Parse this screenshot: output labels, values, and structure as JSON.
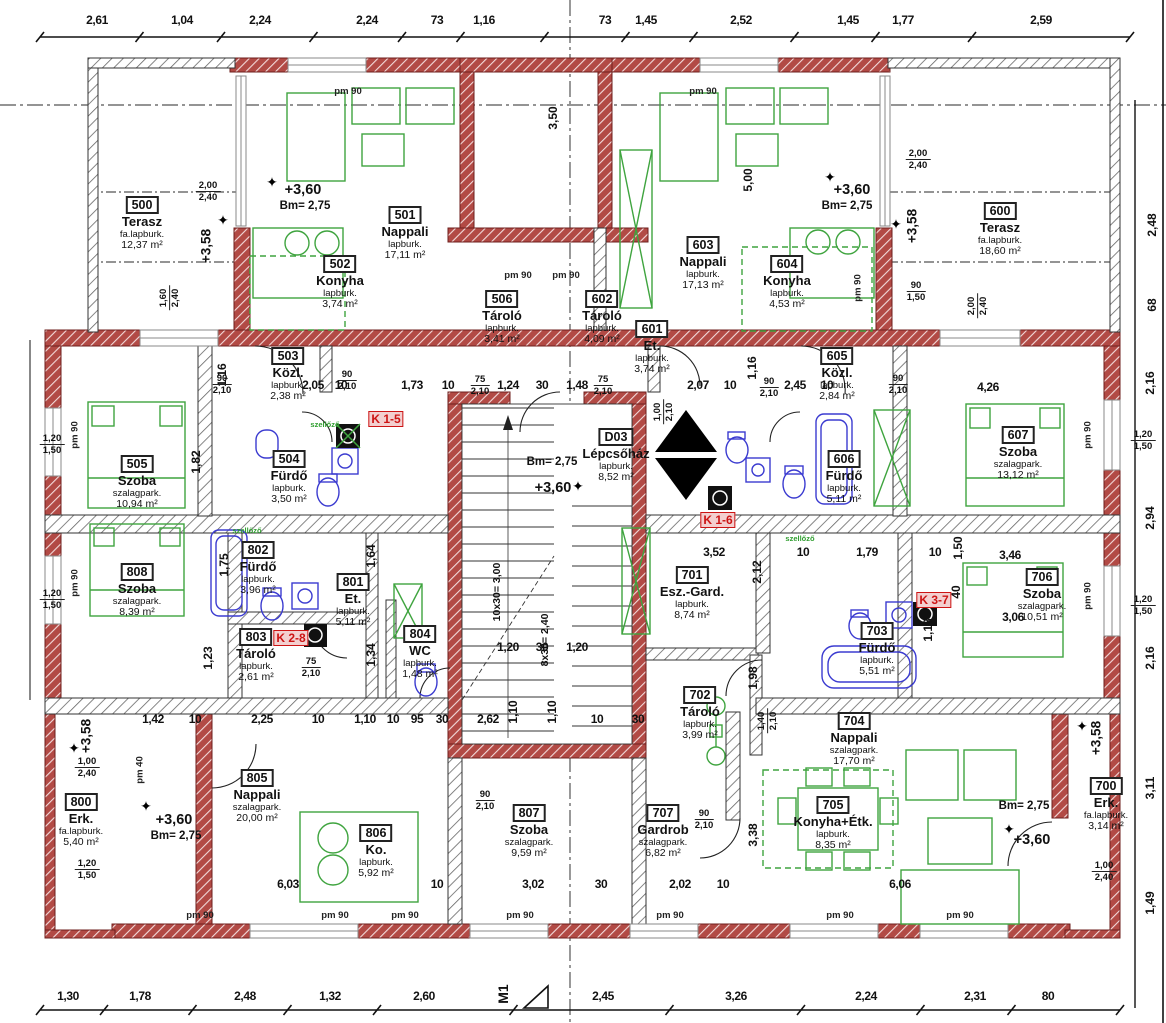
{
  "colors": {
    "wall_red": "#a53230",
    "hatch_grey": "#555555",
    "furniture_green": "#3fa43f",
    "fixture_blue": "#3b3bd0",
    "dim_text": "#111111",
    "k_label_red": "#cc1414",
    "axis_grey": "#555555"
  },
  "rooms": [
    {
      "id": "500",
      "name": "Terasz",
      "floor": "fa.lapburk.",
      "area": "12,37 m²",
      "x": 142,
      "y": 196
    },
    {
      "id": "501",
      "name": "Nappali",
      "floor": "lapburk.",
      "area": "17,11 m²",
      "x": 405,
      "y": 206
    },
    {
      "id": "502",
      "name": "Konyha",
      "floor": "lapburk.",
      "area": "3,74 m²",
      "x": 340,
      "y": 255
    },
    {
      "id": "503",
      "name": "Közl.",
      "floor": "lapburk.",
      "area": "2,38 m²",
      "x": 288,
      "y": 347
    },
    {
      "id": "504",
      "name": "Fürdő",
      "floor": "lapburk.",
      "area": "3,50 m²",
      "x": 289,
      "y": 450
    },
    {
      "id": "505",
      "name": "Szoba",
      "floor": "szalagpark.",
      "area": "10,94 m²",
      "x": 137,
      "y": 455
    },
    {
      "id": "506",
      "name": "Tároló",
      "floor": "lapburk.",
      "area": "3,41 m²",
      "x": 502,
      "y": 290
    },
    {
      "id": "602",
      "name": "Tároló",
      "floor": "lapburk.",
      "area": "4,09 m²",
      "x": 602,
      "y": 290
    },
    {
      "id": "601",
      "name": "Et.",
      "floor": "lapburk.",
      "area": "3,74 m²",
      "x": 652,
      "y": 320
    },
    {
      "id": "603",
      "name": "Nappali",
      "floor": "lapburk.",
      "area": "17,13 m²",
      "x": 703,
      "y": 236
    },
    {
      "id": "604",
      "name": "Konyha",
      "floor": "lapburk.",
      "area": "4,53 m²",
      "x": 787,
      "y": 255
    },
    {
      "id": "605",
      "name": "Közl.",
      "floor": "lapburk.",
      "area": "2,84 m²",
      "x": 837,
      "y": 347
    },
    {
      "id": "606",
      "name": "Fürdő",
      "floor": "lapburk.",
      "area": "5,11 m²",
      "x": 844,
      "y": 450
    },
    {
      "id": "607",
      "name": "Szoba",
      "floor": "szalagpark.",
      "area": "13,12 m²",
      "x": 1018,
      "y": 426
    },
    {
      "id": "600",
      "name": "Terasz",
      "floor": "fa.lapburk.",
      "area": "18,60 m²",
      "x": 1000,
      "y": 202
    },
    {
      "id": "D03",
      "name": "Lépcsőház",
      "floor": "lapburk.",
      "area": "8,52 m²",
      "x": 616,
      "y": 428
    },
    {
      "id": "701",
      "name": "Esz.-Gard.",
      "floor": "lapburk.",
      "area": "8,74 m²",
      "x": 692,
      "y": 566
    },
    {
      "id": "702",
      "name": "Tároló",
      "floor": "lapburk.",
      "area": "3,99 m²",
      "x": 700,
      "y": 686
    },
    {
      "id": "703",
      "name": "Fürdő",
      "floor": "lapburk.",
      "area": "5,51 m²",
      "x": 877,
      "y": 622
    },
    {
      "id": "704",
      "name": "Nappali",
      "floor": "szalagpark.",
      "area": "17,70 m²",
      "x": 854,
      "y": 712
    },
    {
      "id": "705",
      "name": "Konyha+Étk.",
      "floor": "lapburk.",
      "area": "8,35 m²",
      "x": 833,
      "y": 796
    },
    {
      "id": "706",
      "name": "Szoba",
      "floor": "szalagpark.",
      "area": "10,51 m²",
      "x": 1042,
      "y": 568
    },
    {
      "id": "700",
      "name": "Erk.",
      "floor": "fa.lapburk.",
      "area": "3,14 m²",
      "x": 1106,
      "y": 777
    },
    {
      "id": "800",
      "name": "Erk.",
      "floor": "fa.lapburk.",
      "area": "5,40 m²",
      "x": 81,
      "y": 793
    },
    {
      "id": "801",
      "name": "Et.",
      "floor": "lapburk.",
      "area": "5,11 m²",
      "x": 353,
      "y": 573
    },
    {
      "id": "802",
      "name": "Fürdő",
      "floor": "lapburk.",
      "area": "3,96 m²",
      "x": 258,
      "y": 541
    },
    {
      "id": "803",
      "name": "Tároló",
      "floor": "lapburk.",
      "area": "2,61 m²",
      "x": 256,
      "y": 628
    },
    {
      "id": "804",
      "name": "WC",
      "floor": "lapburk.",
      "area": "1,48 m²",
      "x": 420,
      "y": 625
    },
    {
      "id": "805",
      "name": "Nappali",
      "floor": "szalagpark.",
      "area": "20,00 m²",
      "x": 257,
      "y": 769
    },
    {
      "id": "806",
      "name": "Ko.",
      "floor": "lapburk.",
      "area": "5,92 m²",
      "x": 376,
      "y": 824
    },
    {
      "id": "807",
      "name": "Szoba",
      "floor": "szalagpark.",
      "area": "9,59 m²",
      "x": 529,
      "y": 804
    },
    {
      "id": "707",
      "name": "Gardrob",
      "floor": "szalagpark.",
      "area": "6,82 m²",
      "x": 663,
      "y": 804
    },
    {
      "id": "808",
      "name": "Szoba",
      "floor": "szalagpark.",
      "area": "8,39 m²",
      "x": 137,
      "y": 563
    }
  ],
  "dims": {
    "top": [
      {
        "t": "2,61",
        "x": 97
      },
      {
        "t": "1,04",
        "x": 182
      },
      {
        "t": "2,24",
        "x": 260
      },
      {
        "t": "2,24",
        "x": 367
      },
      {
        "t": "73",
        "x": 437
      },
      {
        "t": "1,16",
        "x": 484
      },
      {
        "t": "73",
        "x": 605
      },
      {
        "t": "1,45",
        "x": 646
      },
      {
        "t": "2,52",
        "x": 741
      },
      {
        "t": "1,45",
        "x": 848
      },
      {
        "t": "1,77",
        "x": 903
      },
      {
        "t": "2,59",
        "x": 1041
      }
    ],
    "bottom": [
      {
        "t": "1,30",
        "x": 68
      },
      {
        "t": "1,78",
        "x": 140
      },
      {
        "t": "2,48",
        "x": 245
      },
      {
        "t": "1,32",
        "x": 330
      },
      {
        "t": "2,60",
        "x": 424
      },
      {
        "t": "2,45",
        "x": 603
      },
      {
        "t": "3,26",
        "x": 736
      },
      {
        "t": "2,24",
        "x": 866
      },
      {
        "t": "2,31",
        "x": 975
      },
      {
        "t": "80",
        "x": 1048
      }
    ],
    "h": [
      {
        "t": "2,05",
        "x": 313,
        "y": 378
      },
      {
        "t": "10",
        "x": 341,
        "y": 378
      },
      {
        "t": "1,73",
        "x": 412,
        "y": 378
      },
      {
        "t": "10",
        "x": 448,
        "y": 378
      },
      {
        "t": "1,24",
        "x": 508,
        "y": 378
      },
      {
        "t": "30",
        "x": 542,
        "y": 378
      },
      {
        "t": "1,48",
        "x": 577,
        "y": 378
      },
      {
        "t": "2,07",
        "x": 698,
        "y": 378
      },
      {
        "t": "10",
        "x": 730,
        "y": 378
      },
      {
        "t": "2,45",
        "x": 795,
        "y": 378
      },
      {
        "t": "10",
        "x": 827,
        "y": 378
      },
      {
        "t": "4,26",
        "x": 988,
        "y": 380
      },
      {
        "t": "3,52",
        "x": 714,
        "y": 545
      },
      {
        "t": "10",
        "x": 803,
        "y": 545
      },
      {
        "t": "1,79",
        "x": 867,
        "y": 545
      },
      {
        "t": "10",
        "x": 935,
        "y": 545
      },
      {
        "t": "3,46",
        "x": 1010,
        "y": 548
      },
      {
        "t": "3,06",
        "x": 1013,
        "y": 610
      },
      {
        "t": "1,20",
        "x": 508,
        "y": 640
      },
      {
        "t": "30",
        "x": 542,
        "y": 640
      },
      {
        "t": "1,20",
        "x": 577,
        "y": 640
      },
      {
        "t": "1,42",
        "x": 153,
        "y": 712
      },
      {
        "t": "10",
        "x": 195,
        "y": 712
      },
      {
        "t": "2,25",
        "x": 262,
        "y": 712
      },
      {
        "t": "10",
        "x": 318,
        "y": 712
      },
      {
        "t": "1,10",
        "x": 365,
        "y": 712
      },
      {
        "t": "10",
        "x": 393,
        "y": 712
      },
      {
        "t": "95",
        "x": 417,
        "y": 712
      },
      {
        "t": "30",
        "x": 442,
        "y": 712
      },
      {
        "t": "2,62",
        "x": 488,
        "y": 712
      },
      {
        "t": "10",
        "x": 597,
        "y": 712
      },
      {
        "t": "30",
        "x": 638,
        "y": 712
      },
      {
        "t": "6,03",
        "x": 288,
        "y": 877
      },
      {
        "t": "10",
        "x": 437,
        "y": 877
      },
      {
        "t": "3,02",
        "x": 533,
        "y": 877
      },
      {
        "t": "30",
        "x": 601,
        "y": 877
      },
      {
        "t": "2,02",
        "x": 680,
        "y": 877
      },
      {
        "t": "10",
        "x": 723,
        "y": 877
      },
      {
        "t": "6,06",
        "x": 900,
        "y": 877
      }
    ],
    "v": [
      {
        "t": "3,50",
        "x": 553,
        "y": 118
      },
      {
        "t": "5,00",
        "x": 748,
        "y": 180
      },
      {
        "t": "1,16",
        "x": 222,
        "y": 375
      },
      {
        "t": "1,16",
        "x": 752,
        "y": 368
      },
      {
        "t": "1,82",
        "x": 196,
        "y": 462
      },
      {
        "t": "1,75",
        "x": 224,
        "y": 565
      },
      {
        "t": "1,23",
        "x": 208,
        "y": 658
      },
      {
        "t": "1,64",
        "x": 371,
        "y": 556
      },
      {
        "t": "1,34",
        "x": 371,
        "y": 655
      },
      {
        "t": "1,10",
        "x": 513,
        "y": 712
      },
      {
        "t": "1,10",
        "x": 552,
        "y": 712
      },
      {
        "t": "1,98",
        "x": 753,
        "y": 678
      },
      {
        "t": "2,12",
        "x": 757,
        "y": 572
      },
      {
        "t": "1,50",
        "x": 958,
        "y": 548
      },
      {
        "t": "40",
        "x": 956,
        "y": 592
      },
      {
        "t": "1,18",
        "x": 928,
        "y": 630
      },
      {
        "t": "3,38",
        "x": 753,
        "y": 835
      },
      {
        "t": "2,48",
        "x": 1152,
        "y": 225
      },
      {
        "t": "68",
        "x": 1152,
        "y": 305
      },
      {
        "t": "2,16",
        "x": 1150,
        "y": 383
      },
      {
        "t": "2,94",
        "x": 1150,
        "y": 518
      },
      {
        "t": "2,16",
        "x": 1150,
        "y": 658
      },
      {
        "t": "3,11",
        "x": 1150,
        "y": 788
      },
      {
        "t": "1,49",
        "x": 1150,
        "y": 903
      }
    ]
  },
  "stacked": [
    {
      "a": "2,00",
      "b": "2,40",
      "x": 208,
      "y": 180,
      "r": false
    },
    {
      "a": "2,00",
      "b": "2,40",
      "x": 918,
      "y": 148,
      "r": false
    },
    {
      "a": "90",
      "b": "1,50",
      "x": 916,
      "y": 280,
      "r": false
    },
    {
      "a": "1,20",
      "b": "1,50",
      "x": 52,
      "y": 433,
      "r": false
    },
    {
      "a": "1,20",
      "b": "1,50",
      "x": 52,
      "y": 588,
      "r": false
    },
    {
      "a": "1,20",
      "b": "1,50",
      "x": 1143,
      "y": 429,
      "r": false
    },
    {
      "a": "1,20",
      "b": "1,50",
      "x": 1143,
      "y": 594,
      "r": false
    },
    {
      "a": "90",
      "b": "2,10",
      "x": 222,
      "y": 373,
      "r": false
    },
    {
      "a": "90",
      "b": "2,10",
      "x": 347,
      "y": 369,
      "r": false
    },
    {
      "a": "75",
      "b": "2,10",
      "x": 480,
      "y": 374,
      "r": false
    },
    {
      "a": "75",
      "b": "2,10",
      "x": 603,
      "y": 374,
      "r": false
    },
    {
      "a": "90",
      "b": "2,10",
      "x": 769,
      "y": 376,
      "r": false
    },
    {
      "a": "90",
      "b": "2,10",
      "x": 898,
      "y": 373,
      "r": false
    },
    {
      "a": "75",
      "b": "2,10",
      "x": 311,
      "y": 656,
      "r": false
    },
    {
      "a": "90",
      "b": "2,10",
      "x": 485,
      "y": 789,
      "r": false
    },
    {
      "a": "90",
      "b": "2,10",
      "x": 704,
      "y": 808,
      "r": false
    },
    {
      "a": "1,60",
      "b": "2,40",
      "x": 170,
      "y": 298,
      "r": true
    },
    {
      "a": "2,00",
      "b": "2,40",
      "x": 978,
      "y": 306,
      "r": true
    },
    {
      "a": "1,00",
      "b": "2,10",
      "x": 664,
      "y": 412,
      "r": true
    },
    {
      "a": "1,40",
      "b": "2,10",
      "x": 768,
      "y": 721,
      "r": true
    },
    {
      "a": "1,00",
      "b": "2,40",
      "x": 87,
      "y": 756,
      "r": false
    },
    {
      "a": "1,20",
      "b": "1,50",
      "x": 87,
      "y": 858,
      "r": false
    },
    {
      "a": "1,00",
      "b": "2,40",
      "x": 1104,
      "y": 860,
      "r": false
    }
  ],
  "pm": [
    {
      "t": "pm 90",
      "x": 348,
      "y": 86,
      "r": false
    },
    {
      "t": "pm 90",
      "x": 703,
      "y": 86,
      "r": false
    },
    {
      "t": "pm 90",
      "x": 518,
      "y": 270,
      "r": false
    },
    {
      "t": "pm 90",
      "x": 566,
      "y": 270,
      "r": false
    },
    {
      "t": "pm 90",
      "x": 75,
      "y": 435,
      "r": true
    },
    {
      "t": "pm 90",
      "x": 75,
      "y": 583,
      "r": true
    },
    {
      "t": "pm 90",
      "x": 1088,
      "y": 435,
      "r": true
    },
    {
      "t": "pm 90",
      "x": 1088,
      "y": 596,
      "r": true
    },
    {
      "t": "pm 90",
      "x": 858,
      "y": 288,
      "r": true
    },
    {
      "t": "pm 40",
      "x": 140,
      "y": 770,
      "r": true
    },
    {
      "t": "pm 90",
      "x": 200,
      "y": 910,
      "r": false
    },
    {
      "t": "pm 90",
      "x": 335,
      "y": 910,
      "r": false
    },
    {
      "t": "pm 90",
      "x": 405,
      "y": 910,
      "r": false
    },
    {
      "t": "pm 90",
      "x": 520,
      "y": 910,
      "r": false
    },
    {
      "t": "pm 90",
      "x": 670,
      "y": 910,
      "r": false
    },
    {
      "t": "pm 90",
      "x": 840,
      "y": 910,
      "r": false
    },
    {
      "t": "pm 90",
      "x": 960,
      "y": 910,
      "r": false
    }
  ],
  "ann": [
    {
      "t": "+3,60",
      "x": 303,
      "y": 182,
      "c": "elev"
    },
    {
      "t": "Bm= 2,75",
      "x": 305,
      "y": 200,
      "c": "bm"
    },
    {
      "t": "+3,60",
      "x": 852,
      "y": 182,
      "c": "elev"
    },
    {
      "t": "Bm= 2,75",
      "x": 847,
      "y": 200,
      "c": "bm"
    },
    {
      "t": "Bm= 2,75",
      "x": 552,
      "y": 456,
      "c": "bm"
    },
    {
      "t": "+3,60",
      "x": 553,
      "y": 480,
      "c": "elev"
    },
    {
      "t": "+3,60",
      "x": 174,
      "y": 812,
      "c": "elev"
    },
    {
      "t": "Bm= 2,75",
      "x": 176,
      "y": 830,
      "c": "bm"
    },
    {
      "t": "Bm= 2,75",
      "x": 1024,
      "y": 800,
      "c": "bm"
    },
    {
      "t": "+3,60",
      "x": 1032,
      "y": 832,
      "c": "elev"
    },
    {
      "t": "+3,58",
      "x": 206,
      "y": 246,
      "c": "e358"
    },
    {
      "t": "+3,58",
      "x": 912,
      "y": 226,
      "c": "e358"
    },
    {
      "t": "+3,58",
      "x": 86,
      "y": 736,
      "c": "e358"
    },
    {
      "t": "+3,58",
      "x": 1096,
      "y": 738,
      "c": "e358"
    },
    {
      "t": "K 1-5",
      "x": 386,
      "y": 411,
      "c": "k"
    },
    {
      "t": "K 1-6",
      "x": 718,
      "y": 512,
      "c": "k"
    },
    {
      "t": "K 2-8",
      "x": 291,
      "y": 630,
      "c": "k"
    },
    {
      "t": "K 3-7",
      "x": 934,
      "y": 592,
      "c": "k"
    },
    {
      "t": "szellőző",
      "x": 325,
      "y": 420,
      "c": "gl"
    },
    {
      "t": "szellőző",
      "x": 247,
      "y": 526,
      "c": "gl"
    },
    {
      "t": "szellőző",
      "x": 800,
      "y": 534,
      "c": "gl"
    },
    {
      "t": "10x30= 3,00",
      "x": 497,
      "y": 592,
      "c": "sf"
    },
    {
      "t": "8x30= 2,40",
      "x": 545,
      "y": 640,
      "c": "sf"
    },
    {
      "t": "M1",
      "x": 503,
      "y": 994,
      "c": "m1"
    }
  ],
  "stars": [
    {
      "x": 272,
      "y": 182
    },
    {
      "x": 830,
      "y": 177
    },
    {
      "x": 578,
      "y": 486
    },
    {
      "x": 146,
      "y": 806
    },
    {
      "x": 1009,
      "y": 829
    },
    {
      "x": 223,
      "y": 220
    },
    {
      "x": 896,
      "y": 224
    },
    {
      "x": 74,
      "y": 748
    },
    {
      "x": 1082,
      "y": 726
    }
  ],
  "star_glyph": "✦"
}
